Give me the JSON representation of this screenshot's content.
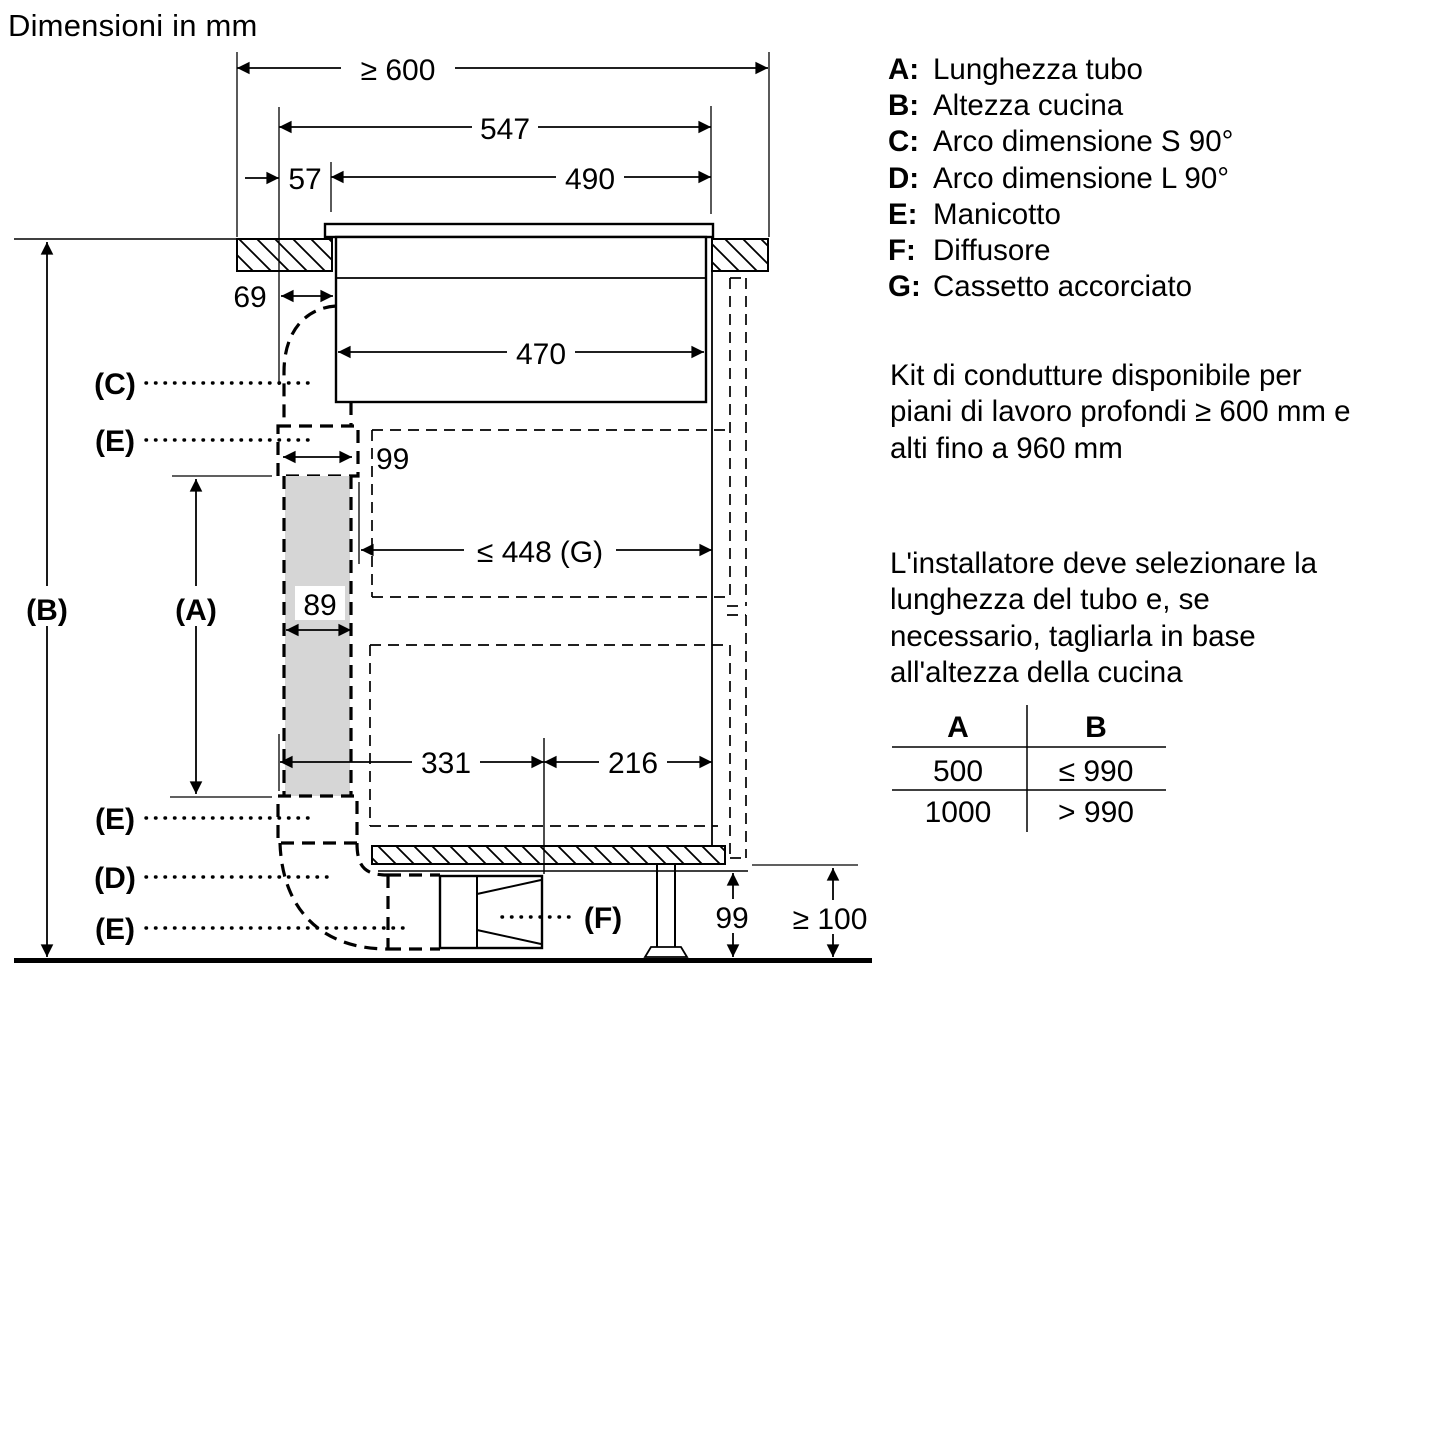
{
  "title": "Dimensioni in mm",
  "legend": {
    "items": [
      {
        "key": "A:",
        "label": "Lunghezza tubo"
      },
      {
        "key": "B:",
        "label": "Altezza cucina"
      },
      {
        "key": "C:",
        "label": "Arco dimensione S 90°"
      },
      {
        "key": "D:",
        "label": "Arco dimensione L 90°"
      },
      {
        "key": "E:",
        "label": "Manicotto"
      },
      {
        "key": "F:",
        "label": "Diffusore"
      },
      {
        "key": "G:",
        "label": "Cassetto accorciato"
      }
    ]
  },
  "notes": {
    "kit": {
      "line1": "Kit di condutture disponibile per",
      "line2": "piani di lavoro profondi ≥ 600 mm e",
      "line3": "alti fino a 960 mm"
    },
    "installer": {
      "line1": "L'installatore deve selezionare la",
      "line2": "lunghezza del tubo e, se",
      "line3": "necessario, tagliarla in base",
      "line4": "all'altezza della cucina"
    }
  },
  "table": {
    "headers": {
      "a": "A",
      "b": "B"
    },
    "rows": [
      {
        "a": "500",
        "b": "≤ 990"
      },
      {
        "a": "1000",
        "b": "> 990"
      }
    ]
  },
  "dims": {
    "worktop_depth": "≥ 600",
    "hob_width": "547",
    "offset_57": "57",
    "cutout_width": "490",
    "body_width": "470",
    "offset_69": "69",
    "manicotto_width": "99",
    "duct_width": "89",
    "drawer_width": "≤ 448",
    "drawer_width_ref": "(G)",
    "dist_331": "331",
    "dist_216": "216",
    "plinth_height": "99",
    "floor_clearance": "≥ 100"
  },
  "labels": {
    "a": "(A)",
    "b": "(B)",
    "c": "(C)",
    "d": "(D)",
    "e": "(E)",
    "f": "(F)"
  },
  "colors": {
    "line": "#000000",
    "duct_fill": "#d6d6d6",
    "background": "#ffffff"
  }
}
